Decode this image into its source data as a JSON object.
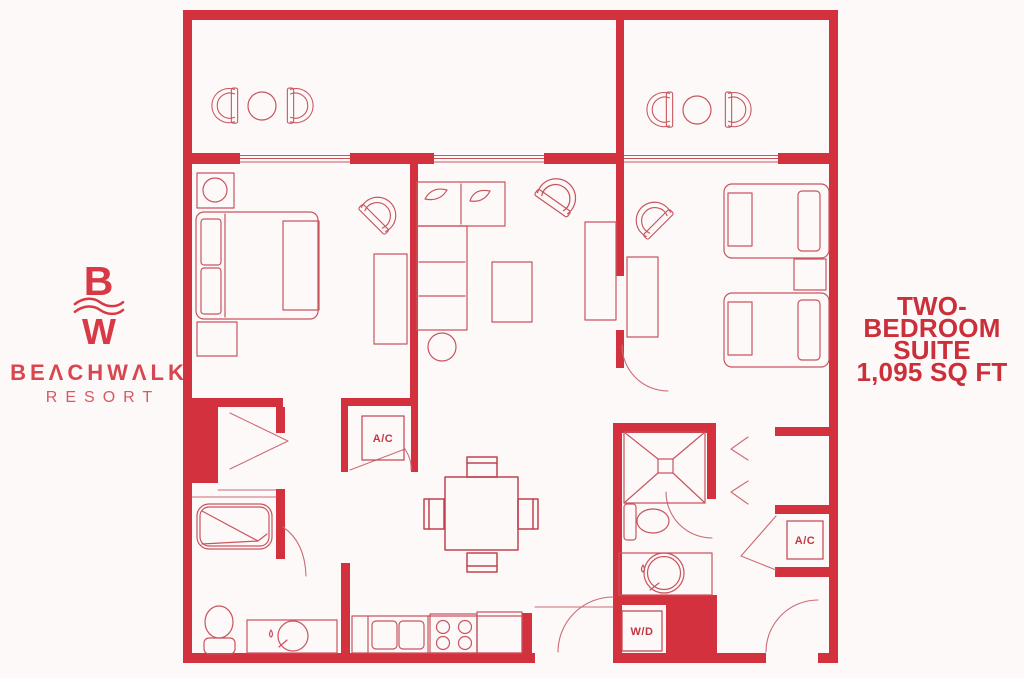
{
  "colors": {
    "background": "#FDF9F9",
    "wall_red": "#D2313D",
    "furniture_line_red": "#C8545E",
    "logo_red": "#D83944",
    "title_red": "#CB2F39"
  },
  "brand": {
    "monogram_top": "B",
    "monogram_bottom": "W",
    "name": "BEΛCHWΛLK",
    "subtitle": "RESORT"
  },
  "suite": {
    "title_line1": "TWO-BEDROOM",
    "title_line2": "SUITE",
    "title_line3": "1,095 SQ FT"
  },
  "floorplan": {
    "labels": {
      "ac_closet_1": "A/C",
      "ac_closet_2": "A/C",
      "washer_dryer": "W/D"
    }
  }
}
